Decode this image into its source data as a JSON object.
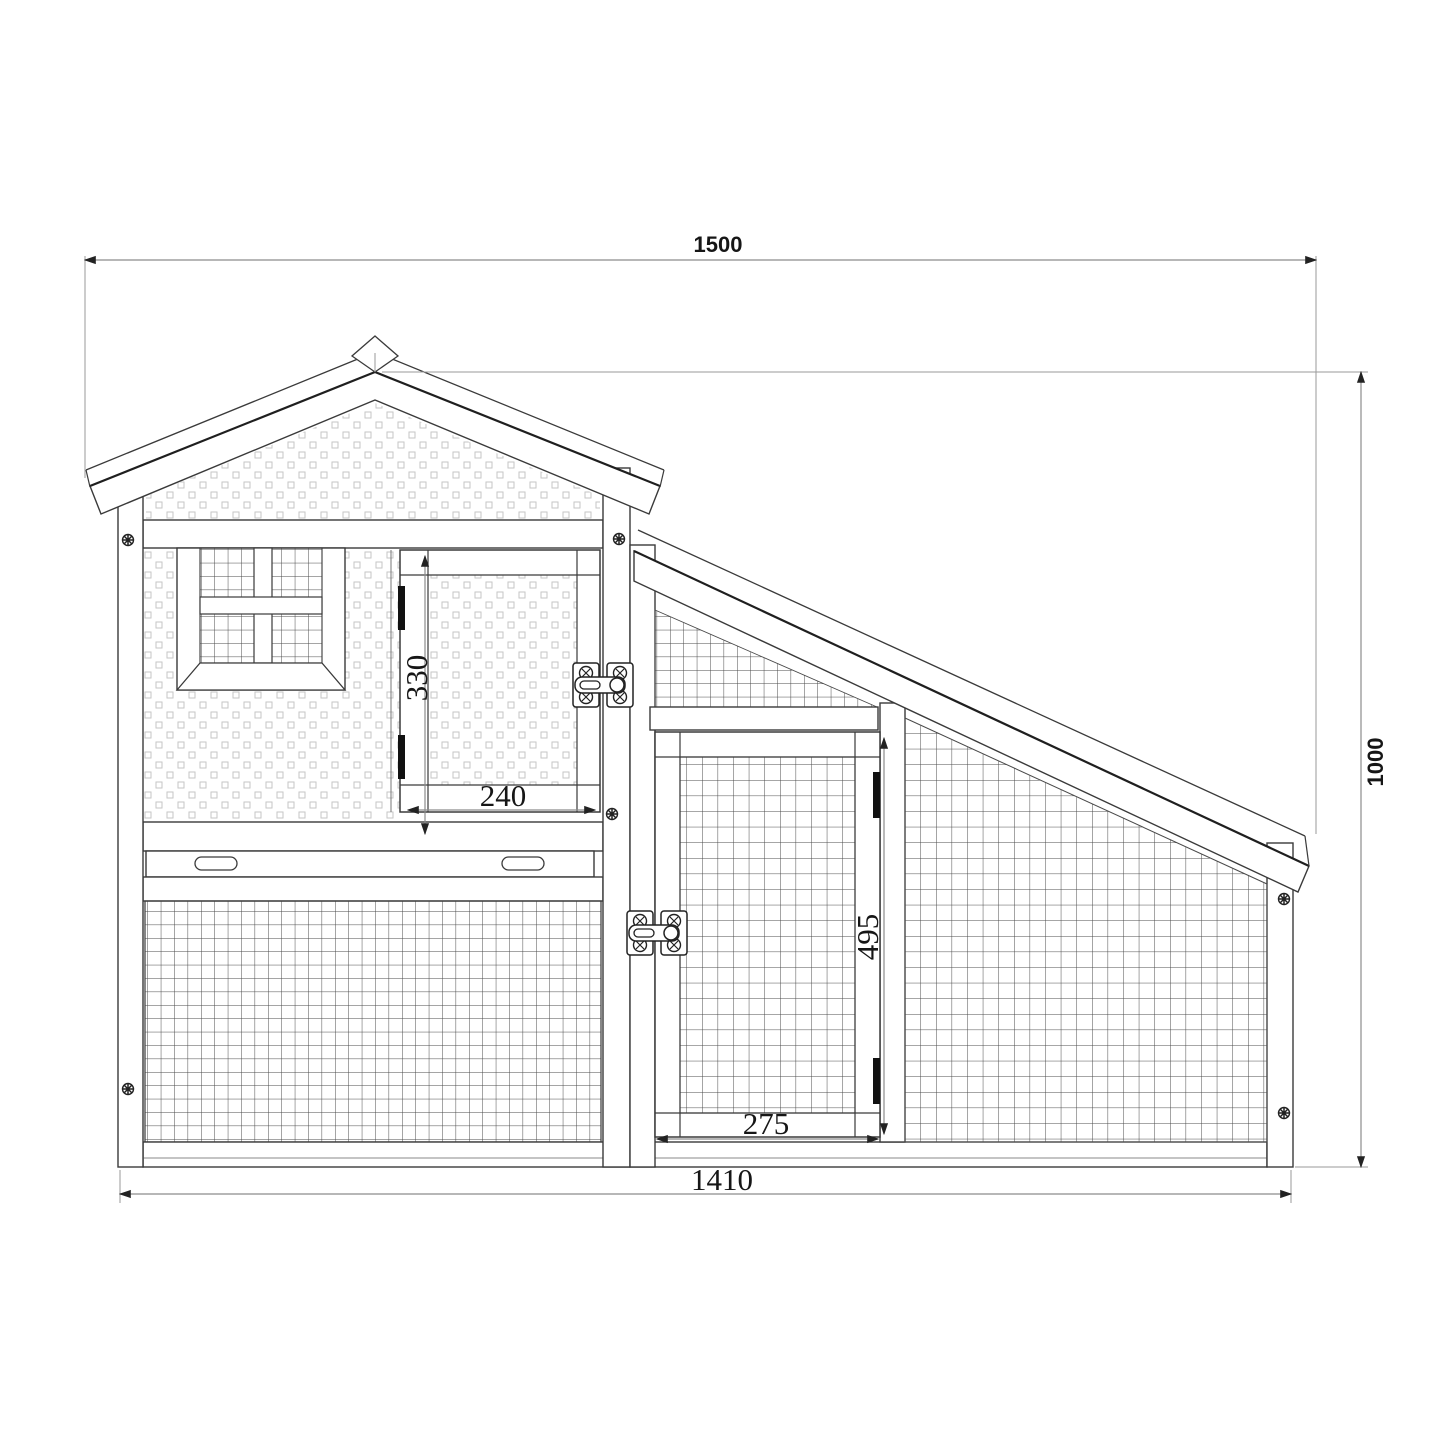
{
  "drawing": {
    "type": "technical-elevation-diagram",
    "subject": "wooden hutch / chicken coop front elevation with wire mesh run",
    "units_shown": "mm",
    "dimensions": {
      "overall_width": "1500",
      "overall_height": "1000",
      "base_width": "1410",
      "house_door_height": "330",
      "house_door_width": "240",
      "run_door_height": "495",
      "run_door_width": "275"
    },
    "colors": {
      "background": "#ffffff",
      "outline": "#3a3a3a",
      "dark_edge": "#1f1f1f",
      "dimension_line": "#8c8c8c",
      "extension_line": "#9a9a9a",
      "text": "#161616",
      "texture": "#c6c6c6",
      "mesh": "#4a4a4a",
      "hardware_fill": "#111111"
    },
    "parts": [
      "gable roof house with stippled wood panel walls",
      "cross-mullioned wire mesh window",
      "hinged panel door with slide bolt latch",
      "pull-out tray with two handle slots",
      "lower wire mesh front panel",
      "sloped roof wire mesh run",
      "wire mesh run door with slide bolt latch and hinges"
    ]
  }
}
